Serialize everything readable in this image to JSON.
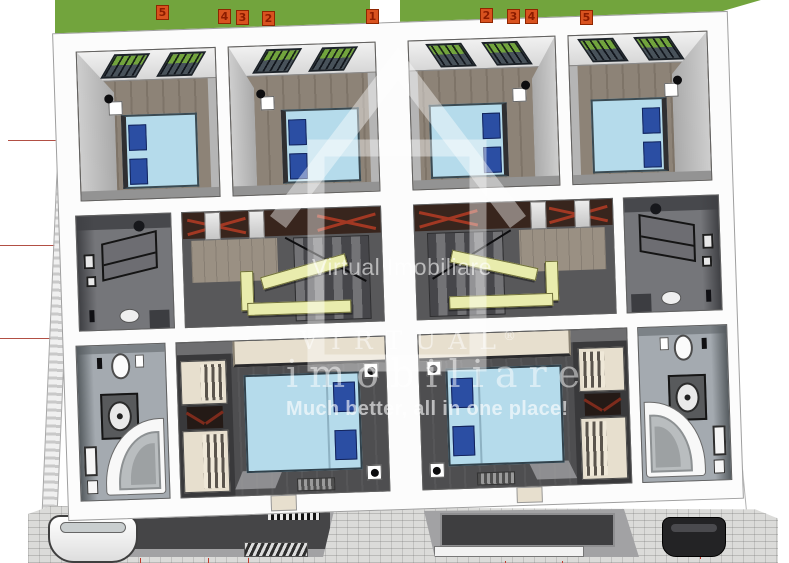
{
  "watermark": {
    "small_label": "Virtual Imobiliare",
    "brand_line1": "VIRTUAL",
    "reg_mark": "®",
    "brand_line2": "imobiliare",
    "tagline": "Much better, all in one place!"
  },
  "lot_markers": {
    "left": [
      "5",
      "4",
      "3",
      "2",
      "1"
    ],
    "right": [
      "2",
      "3",
      "4",
      "5"
    ]
  },
  "colors": {
    "grass": "#72a43d",
    "marker_bg": "#d9521f",
    "marker_text": "#8c1c00",
    "bed_blue": "#b5dbeb",
    "pillow_navy": "#2b4ea3",
    "stair_yellow": "#e9ecad",
    "cream": "#e7dfce",
    "floor_wood": "#8d8377",
    "floor_dark": "#4e4e50",
    "bath_floor": "#a4aab0",
    "truss_brown": "#38251d",
    "truss_red": "#a23823",
    "paving": "#dbdbd9",
    "survey_red": "#b24f44",
    "watermark_white": "rgba(255,255,255,0.5)"
  },
  "scene": {
    "units": [
      "unit-left",
      "unit-right-mirrored"
    ],
    "rooms": [
      "bedroom-outer",
      "bedroom-inner",
      "dressing-room",
      "stair-hall",
      "bathroom",
      "master-bedroom"
    ],
    "exterior": [
      "lawn",
      "lot-markers",
      "brick-walkway",
      "survey-lines",
      "paved-driveway",
      "entrance-terrace-left",
      "entrance-terrace-right",
      "white-car",
      "dark-car"
    ]
  }
}
